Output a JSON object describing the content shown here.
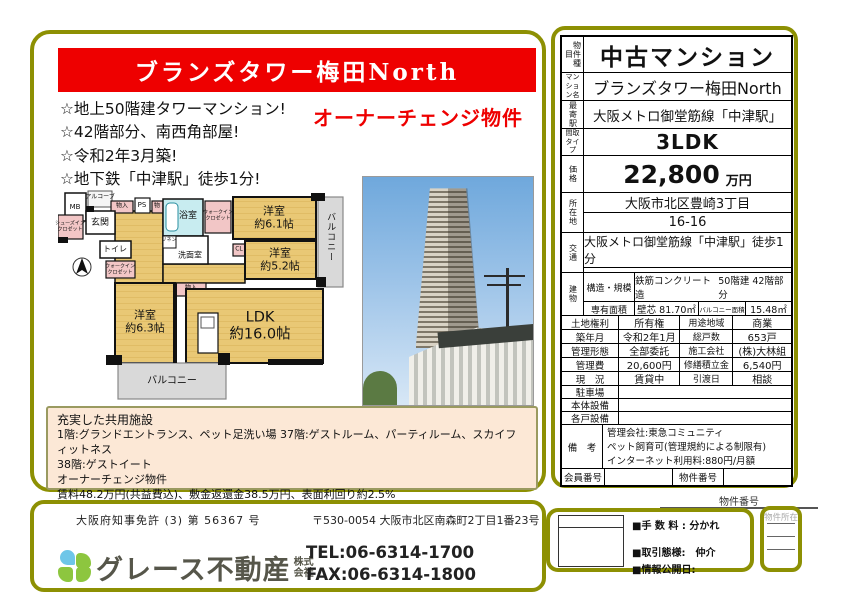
{
  "banner": {
    "title": "ブランズタワー梅田North"
  },
  "highlights": [
    "☆地上50階建タワーマンション!",
    "☆42階部分、南西角部屋!",
    "☆令和2年3月築!",
    "☆地下鉄「中津駅」徒歩1分!"
  ],
  "owner_change": "オーナーチェンジ物件",
  "floorplan": {
    "mb": "MB",
    "alcove": "アルコーブ",
    "st1": "物入",
    "ps": "PS",
    "st2": "物",
    "sic1": "シューズイン",
    "sic2": "クロゼット",
    "entrance": "玄関",
    "toilet": "トイレ",
    "wic1": "ウォークイン",
    "wic2": "クロゼット",
    "bath": "浴室",
    "linen": "リネン",
    "wash": "洗面室",
    "cl": "CL",
    "st3": "物入",
    "r1_name": "洋室",
    "r1_size": "約6.1帖",
    "r2_name": "洋室",
    "r2_size": "約5.2帖",
    "r3_name": "洋室",
    "r3_size": "約6.3帖",
    "ldk_name": "LDK",
    "ldk_size": "約16.0帖",
    "balcony_r": "バルコニー",
    "balcony_b": "バルコニー"
  },
  "spec": {
    "type_label": "物件種目",
    "type": "中古マンション",
    "name_label": "マンション名",
    "name": "ブランズタワー梅田North",
    "station_label": "最寄駅",
    "station": "大阪メトロ御堂筋線「中津駅」",
    "plan_label": "間取タイプ",
    "plan": "3LDK",
    "price_label": "価格",
    "price": "22,800",
    "price_unit": "万円",
    "addr_label": "所在地",
    "addr1": "大阪市北区豊崎3丁目",
    "addr2": "16-16",
    "access_label": "交通",
    "access": "大阪メトロ御堂筋線「中津駅」徒歩1分",
    "bldg_label": "建物",
    "structure_label": "構造・規模",
    "structure": "鉄筋コンクリート造",
    "structure2": "50階建 42階部分",
    "area_label": "専有面積",
    "area": "壁芯 81.70㎡",
    "balcony_area_label": "バルコニー面積",
    "balcony_area": "15.48㎡",
    "plan_detail_label": "間取内訳",
    "plan_detail": "LDK約13.0帖 洋室約5.6帖 洋室約4.2帖",
    "land_label": "土地権利",
    "land": "所有権",
    "zoning_label": "用途地域",
    "zoning": "商業",
    "built_label": "築年月",
    "built": "令和2年1月",
    "units_label": "総戸数",
    "units": "653戸",
    "mgmt_label": "管理形態",
    "mgmt": "全部委託",
    "constructor_label": "施工会社",
    "constructor": "(株)大林組",
    "fee_label": "管理費",
    "fee": "20,600円",
    "reserve_label": "修繕積立金",
    "reserve": "6,540円",
    "current_label": "現　況",
    "current": "賃貸中",
    "handover_label": "引渡日",
    "handover": "相談",
    "parking_label": "駐車場",
    "main_equip_label": "本体設備",
    "unit_equip_label": "各戸設備",
    "notes_label": "備　考",
    "notes1": "管理会社:東急コミュニティ",
    "notes2": "ペット飼育可(管理規約による制限有)",
    "notes3": "インターネット利用料:880円/月額",
    "member_label": "会員番号",
    "propno_label": "物件番号"
  },
  "facilities": {
    "title": "充実した共用施設",
    "line1": "1階:グランドエントランス、ペット足洗い場  37階:ゲストルーム、パーティルーム、スカイフィットネス",
    "line2": "38階:ゲストイート",
    "line3": "オーナーチェンジ物件",
    "line4": "賃料48.2万円(共益費込)、敷金返還金38.5万円、表面利回り約2.5%"
  },
  "footer": {
    "license": "大阪府知事免許 (3) 第  56367  号",
    "address": "〒530-0054 大阪市北区南森町2丁目1番23号",
    "company": "グレース不動産",
    "kabu1": "株式",
    "kabu2": "会社",
    "tel": "TEL:06-6314-1700",
    "fax": "FAX:06-6314-1800"
  },
  "deal": {
    "propno_label": "物件番号",
    "fee": "■手 数 料 : 分かれ",
    "style": "■取引態様:　仲介",
    "date": "■情報公開日:",
    "location": "物件所在"
  },
  "colors": {
    "accent_red": "#ee0000",
    "frame_olive": "#8d9003",
    "facilities_bg": "#fce8d6"
  }
}
